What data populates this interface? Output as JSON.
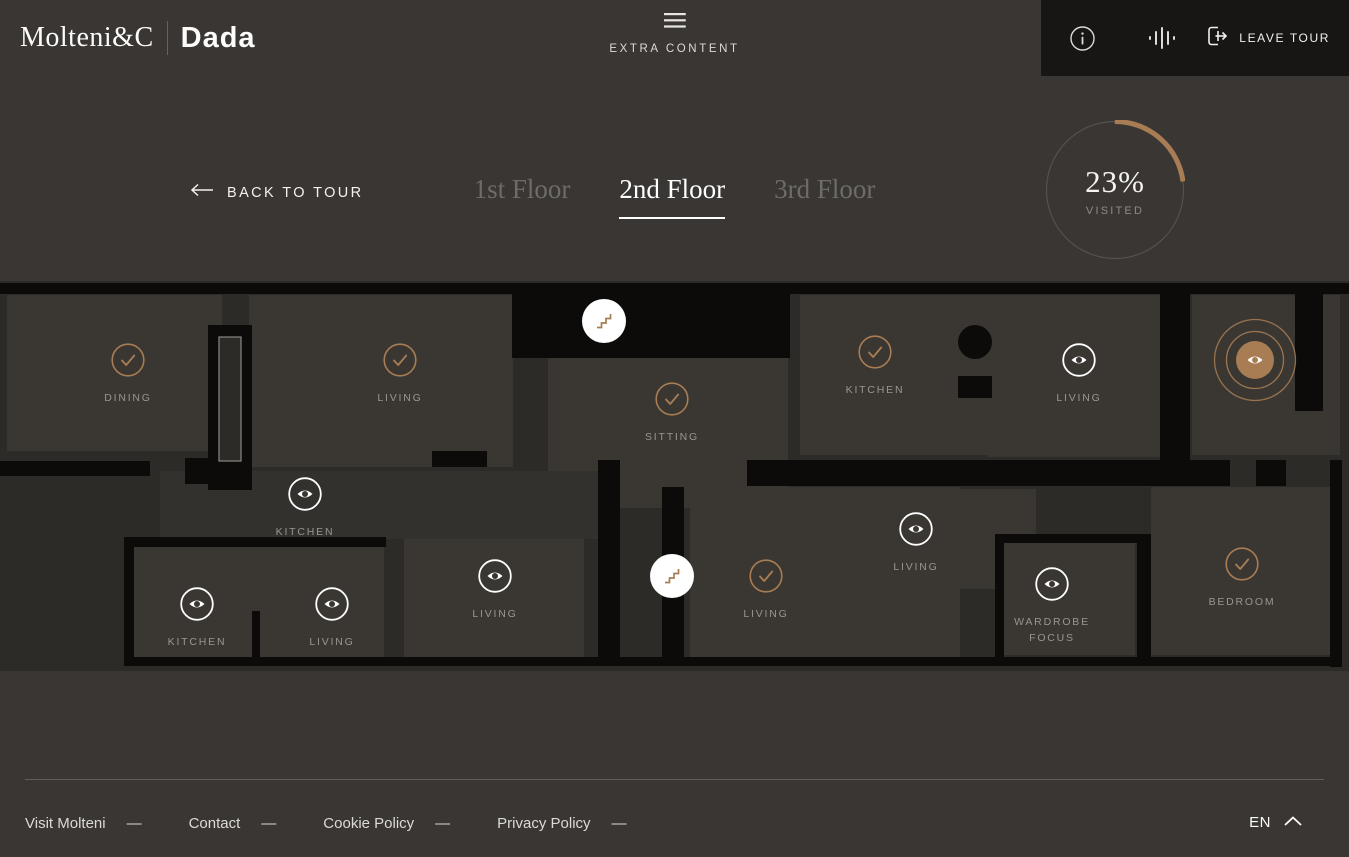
{
  "header": {
    "logo_primary": "Molteni&C",
    "logo_secondary": "Dada",
    "extra_content_label": "EXTRA CONTENT",
    "leave_tour_label": "LEAVE TOUR"
  },
  "tour_nav": {
    "back_label": "BACK TO TOUR",
    "floors": [
      {
        "label": "1st Floor",
        "active": false
      },
      {
        "label": "2nd Floor",
        "active": true
      },
      {
        "label": "3rd Floor",
        "active": false
      }
    ],
    "progress": {
      "percent_label": "23%",
      "percent_value": 23,
      "caption": "VISITED"
    }
  },
  "plan": {
    "markers": [
      {
        "type": "check",
        "x": 128,
        "y": 79,
        "label": "DINING"
      },
      {
        "type": "check",
        "x": 400,
        "y": 79,
        "label": "LIVING"
      },
      {
        "type": "eye",
        "x": 305,
        "y": 213,
        "label": "KITCHEN"
      },
      {
        "type": "check",
        "x": 672,
        "y": 118,
        "label": "SITTING"
      },
      {
        "type": "check",
        "x": 875,
        "y": 71,
        "label": "KITCHEN"
      },
      {
        "type": "eye",
        "x": 1079,
        "y": 79,
        "label": "LIVING"
      },
      {
        "type": "active",
        "x": 1255,
        "y": 79,
        "label": ""
      },
      {
        "type": "stairs",
        "x": 604,
        "y": 40,
        "label": ""
      },
      {
        "type": "stairs",
        "x": 672,
        "y": 295,
        "label": ""
      },
      {
        "type": "eye",
        "x": 197,
        "y": 323,
        "label": "KITCHEN"
      },
      {
        "type": "eye",
        "x": 332,
        "y": 323,
        "label": "LIVING"
      },
      {
        "type": "eye",
        "x": 495,
        "y": 295,
        "label": "LIVING"
      },
      {
        "type": "check",
        "x": 766,
        "y": 295,
        "label": "LIVING"
      },
      {
        "type": "eye",
        "x": 916,
        "y": 248,
        "label": "LIVING"
      },
      {
        "type": "eye",
        "x": 1052,
        "y": 303,
        "label": "WARDROBE\nFOCUS"
      },
      {
        "type": "check",
        "x": 1242,
        "y": 283,
        "label": "BEDROOM"
      }
    ]
  },
  "footer": {
    "links": [
      "Visit Molteni",
      "Contact",
      "Cookie Policy",
      "Privacy Policy"
    ],
    "dash": "—",
    "language": "EN"
  },
  "colors": {
    "copper": "#a87d54",
    "background": "#393633",
    "panel": "#181614",
    "plan_background": "#2d2b28",
    "room": "#3a3733",
    "wall": "#0c0b09",
    "label_gray": "#98968f"
  }
}
